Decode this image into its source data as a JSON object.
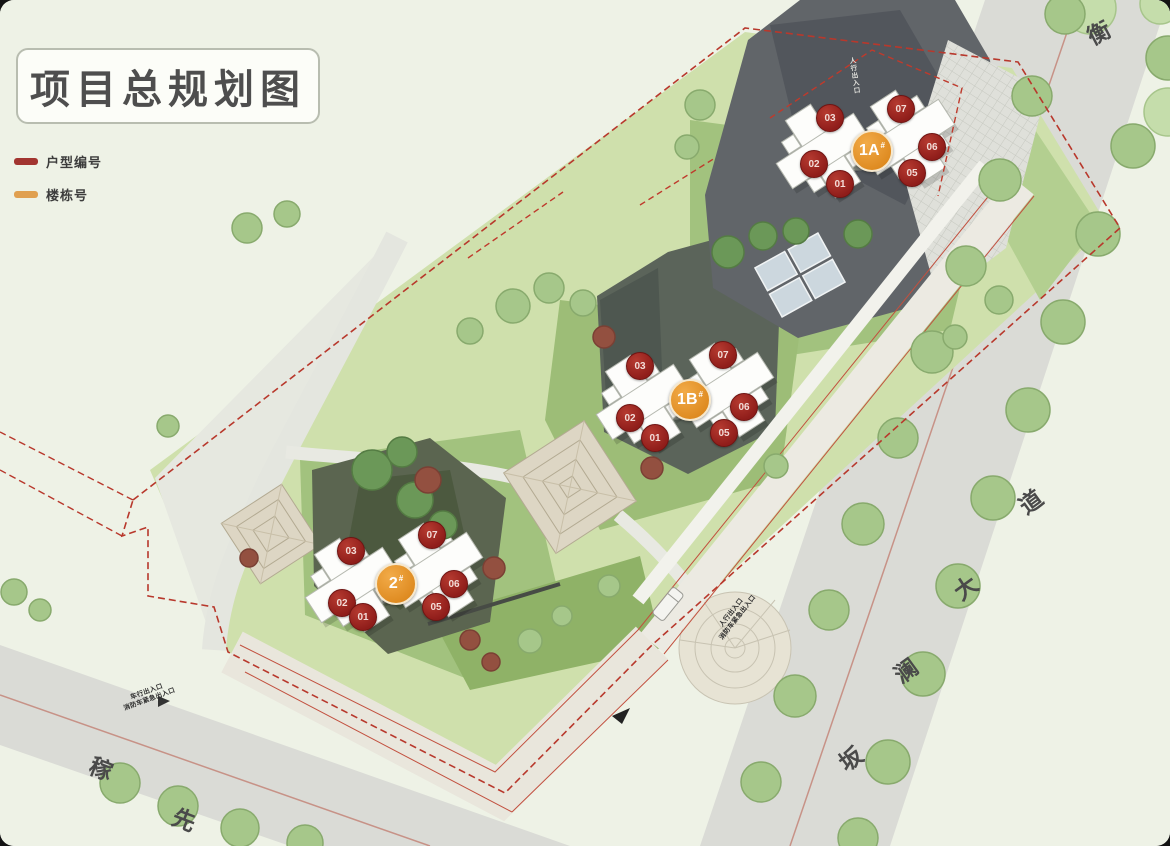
{
  "title": "项目总规划图",
  "legend": {
    "items": [
      {
        "label": "户型编号",
        "color": "#a23530"
      },
      {
        "label": "楼栋号",
        "color": "#e0a050"
      }
    ]
  },
  "buildings": [
    {
      "label": "1A",
      "mark": "#",
      "units": [
        "03",
        "02",
        "01",
        "07",
        "06",
        "05"
      ]
    },
    {
      "label": "1B",
      "mark": "#",
      "units": [
        "03",
        "02",
        "01",
        "07",
        "06",
        "05"
      ]
    },
    {
      "label": "2",
      "mark": "#",
      "units": [
        "03",
        "02",
        "01",
        "07",
        "06",
        "05"
      ]
    }
  ],
  "roads": {
    "banlan": {
      "name": "坂澜大道",
      "chars": [
        "坂",
        "澜",
        "大",
        "道"
      ]
    },
    "heng": {
      "name": "衡",
      "chars": [
        "衡"
      ]
    },
    "jiaxian": {
      "name": "稼先",
      "chars": [
        "稼",
        "先"
      ]
    }
  },
  "entrances": {
    "vehicle": {
      "lines": [
        "车行出入口",
        "消防车紧急出入口"
      ]
    },
    "pedestrian": {
      "lines": [
        "人行出入口",
        "消防车紧急出入口"
      ]
    },
    "roof": {
      "lines": [
        "人行出入口"
      ]
    }
  },
  "colors": {
    "boundary_red": "#b8382c",
    "unit_badge": "#9e2420",
    "building_badge": "#e8962e",
    "roof_gray": "#616569",
    "lawn_green": "#a2c27e",
    "road_gray": "#dadbd6"
  }
}
